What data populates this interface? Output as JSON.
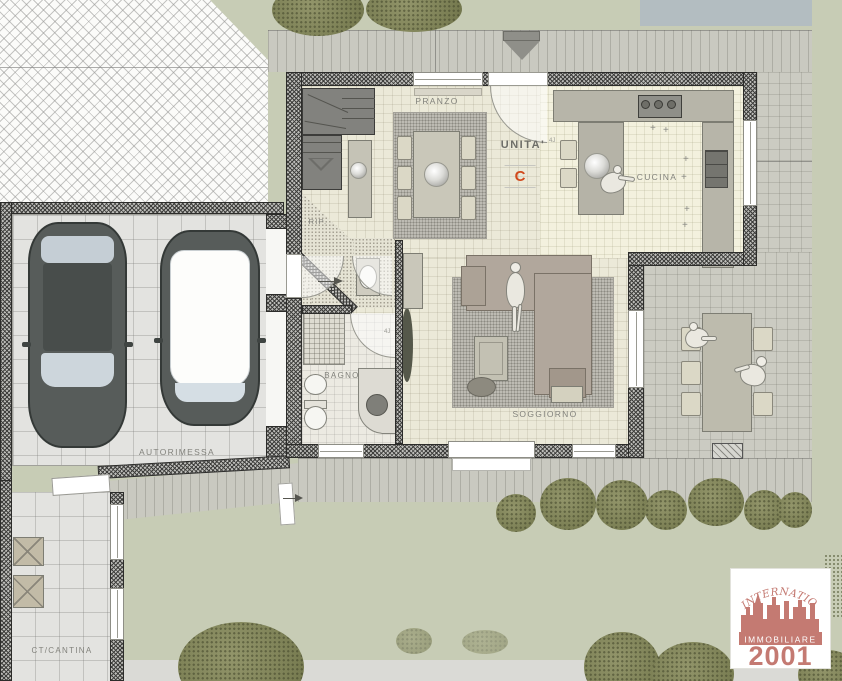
{
  "unit": {
    "label": "UNITA'",
    "letter": "C",
    "letter_color": "#d14a1d"
  },
  "rooms": {
    "dining": "PRANZO",
    "kitchen": "CUCINA",
    "storage": "RIP.",
    "bathroom": "BAGNO",
    "living": "SOGGIORNO",
    "garage": "AUTORIMESSA",
    "cellar": "CT/CANTINA"
  },
  "door_tag": "4J",
  "logo": {
    "arc_text": "INTERNATIONAL",
    "brand": "IMMOBILIARE",
    "year": "2001",
    "color": "#c47a72"
  },
  "colors": {
    "lawn": "#c7ccb5",
    "patio": "#cbcbc2",
    "interior_floor": "#ebe9d8",
    "accent_letter": "#d14a1d",
    "logo_salmon": "#c47a72",
    "roof_shadow": "#b3bdc1"
  }
}
